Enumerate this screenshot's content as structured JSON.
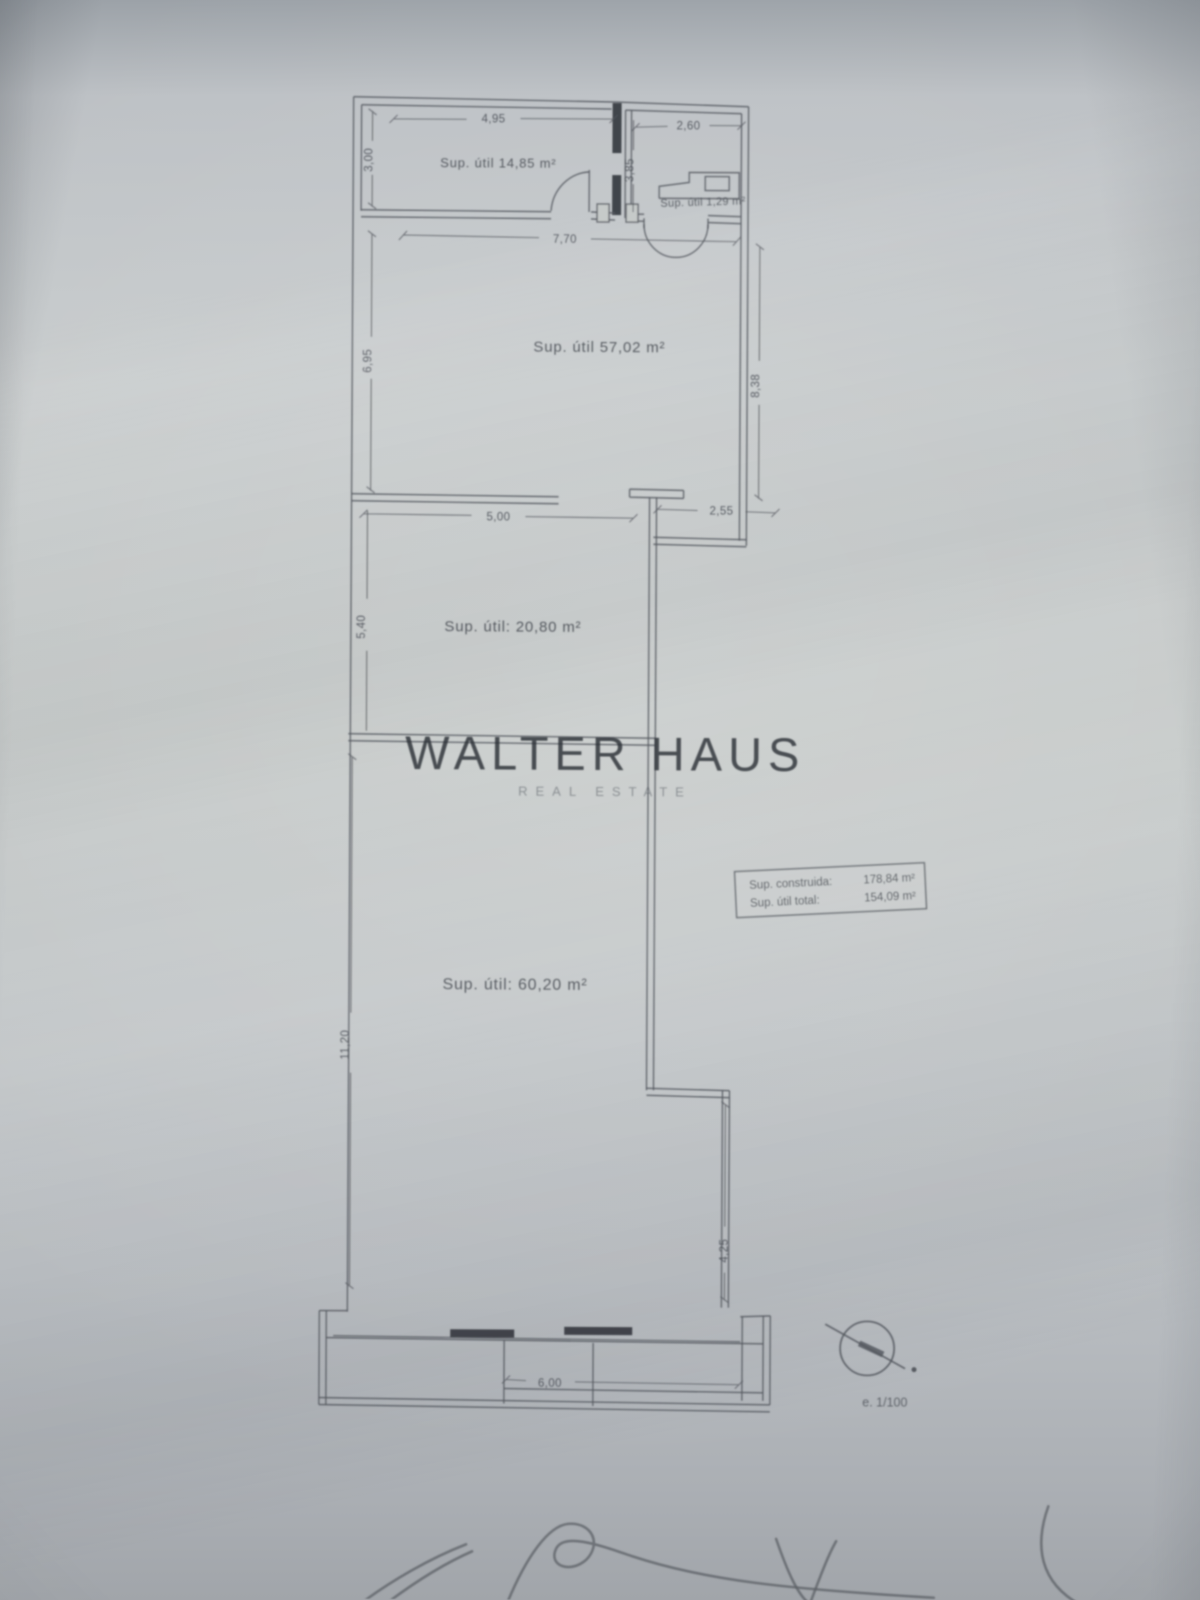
{
  "watermark": {
    "name": "WALTER HAUS",
    "tagline": "REAL ESTATE"
  },
  "plan": {
    "rooms": [
      {
        "label": "Sup. útil  14,85 m²"
      },
      {
        "label": "Sup. útil 1,29 m²"
      },
      {
        "label": "Sup. útil  57,02 m²"
      },
      {
        "label": "Sup. útil:  20,80 m²"
      },
      {
        "label": "Sup. útil:  60,20 m²"
      }
    ],
    "dims": {
      "top_left_room": {
        "width": "4,95",
        "height": "3,00"
      },
      "top_right_room": {
        "width": "2,60",
        "height": "3,85"
      },
      "main_room": {
        "top": "7,70",
        "left": "6,95",
        "right": "8,38",
        "bottom_left": "5,00",
        "bottom_right": "2,55"
      },
      "middle_room": {
        "left": "5,40"
      },
      "bottom_room": {
        "left": "11,20",
        "right": "4,25"
      },
      "terrace": {
        "width": "6,00"
      }
    },
    "summary": {
      "row1_label": "Sup. construida:",
      "row1_value": "178,84 m²",
      "row2_label": "Sup. útil total:",
      "row2_value": "154,09 m²"
    },
    "scale": "e. 1/100"
  }
}
